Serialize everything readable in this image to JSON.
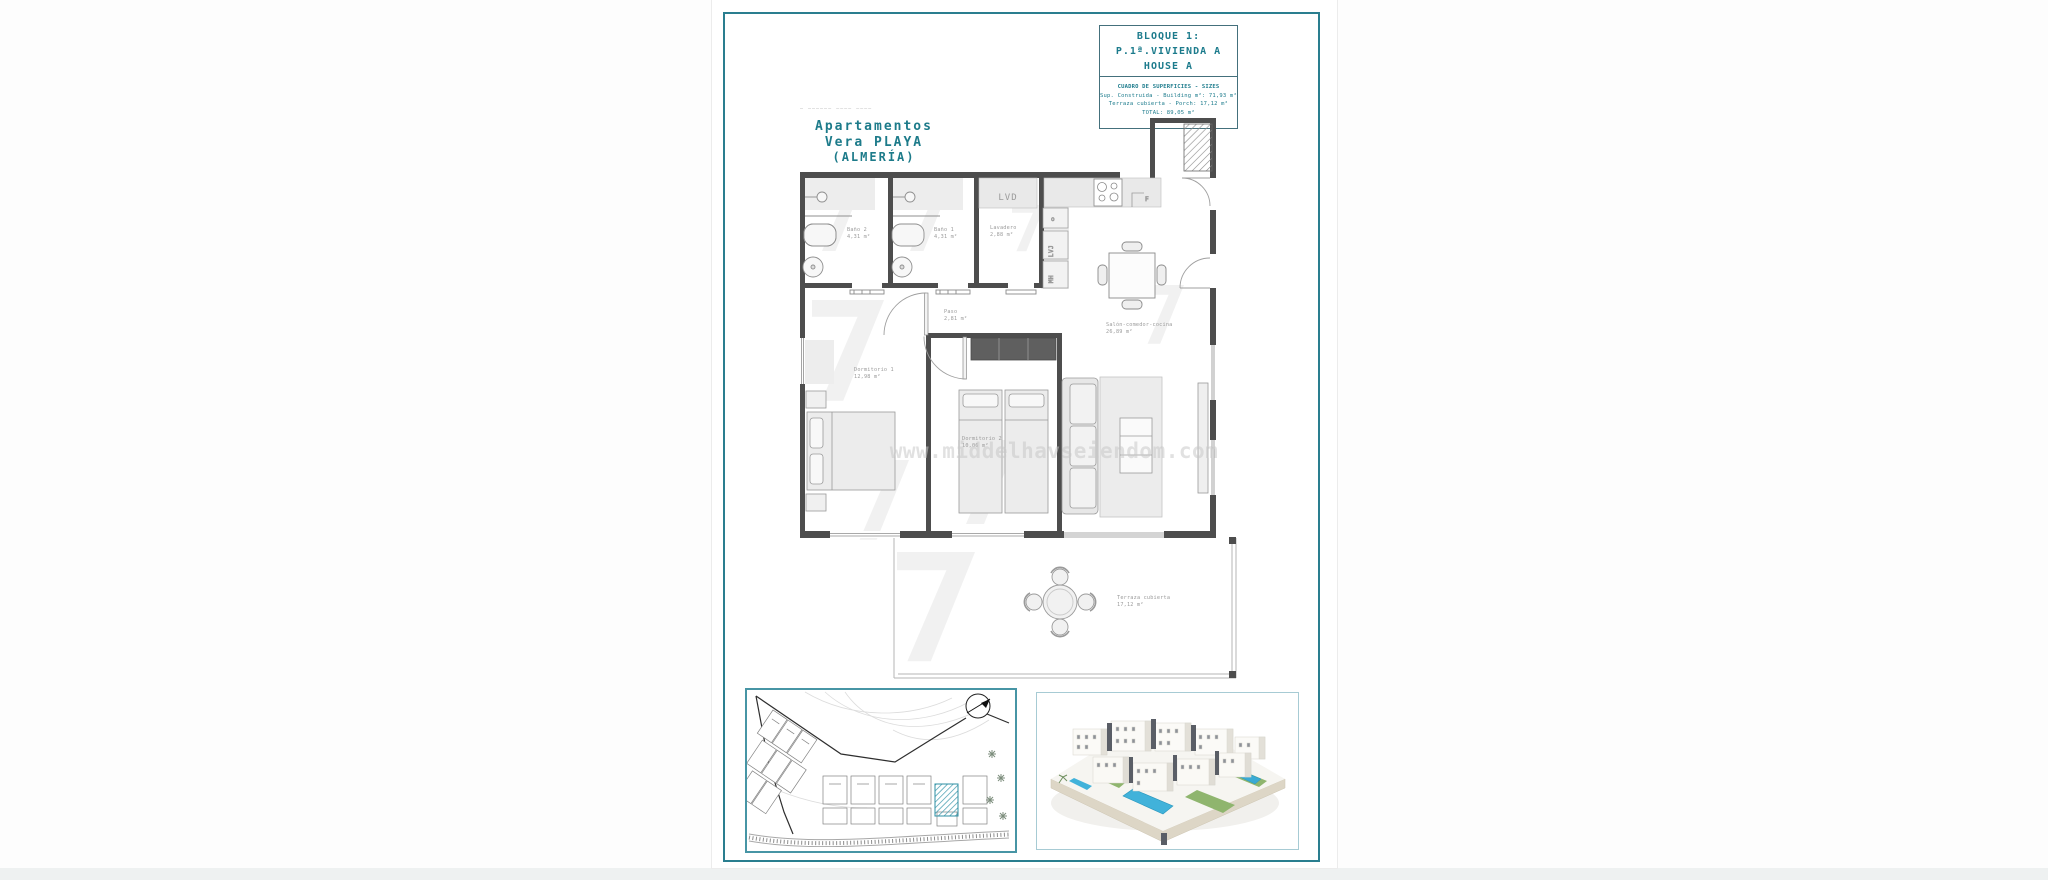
{
  "note_small": "— —————— ———— ————",
  "project": {
    "l1": "Apartamentos",
    "l2": "Vera PLAYA",
    "l3": "(ALMERÍA)"
  },
  "title_block": {
    "l1": "BLOQUE 1:",
    "l2": "P.1ª.VIVIENDA A",
    "l3": "HOUSE A",
    "sizes_title": "CUADRO DE SUPERFICIES  - SIZES",
    "s1": "Sup. Construida  - Building m²: 71,93 m²",
    "s2": "Terraza cubierta   - Porch: 17,12 m²",
    "s3": "TOTAL:  89,05 m²"
  },
  "plan": {
    "rooms": {
      "bano2": {
        "name": "Baño 2",
        "area": "4,31 m²"
      },
      "bano1": {
        "name": "Baño 1",
        "area": "4,31 m²"
      },
      "lavadero": {
        "name": "Lavadero",
        "area": "2,88 m²"
      },
      "paso": {
        "name": "Paso",
        "area": "2,81 m²"
      },
      "dorm1": {
        "name": "Dormitorio 1",
        "area": "12,98 m²"
      },
      "dorm2": {
        "name": "Dormitorio 2",
        "area": "10,06 m²"
      },
      "salon": {
        "name": "Salón-comedor-cocina",
        "area": "26,89 m²"
      },
      "terraza": {
        "name": "Terraza cubierta",
        "area": "17,12 m²"
      }
    },
    "appliances": {
      "lvd": "LVD",
      "lvj": "LVJ",
      "mh": "MH",
      "f": "F",
      "oven": "o"
    },
    "watermark": "www.middelhavseiendom.com"
  },
  "colors": {
    "accent_teal": "#2a7e8f",
    "title_teal": "#1d7b8a",
    "wall_gray": "#4d4d4d",
    "site_hatch_teal": "#3e99ad",
    "pool_blue": "#41b2da",
    "lawn_green": "#8fb56e"
  }
}
